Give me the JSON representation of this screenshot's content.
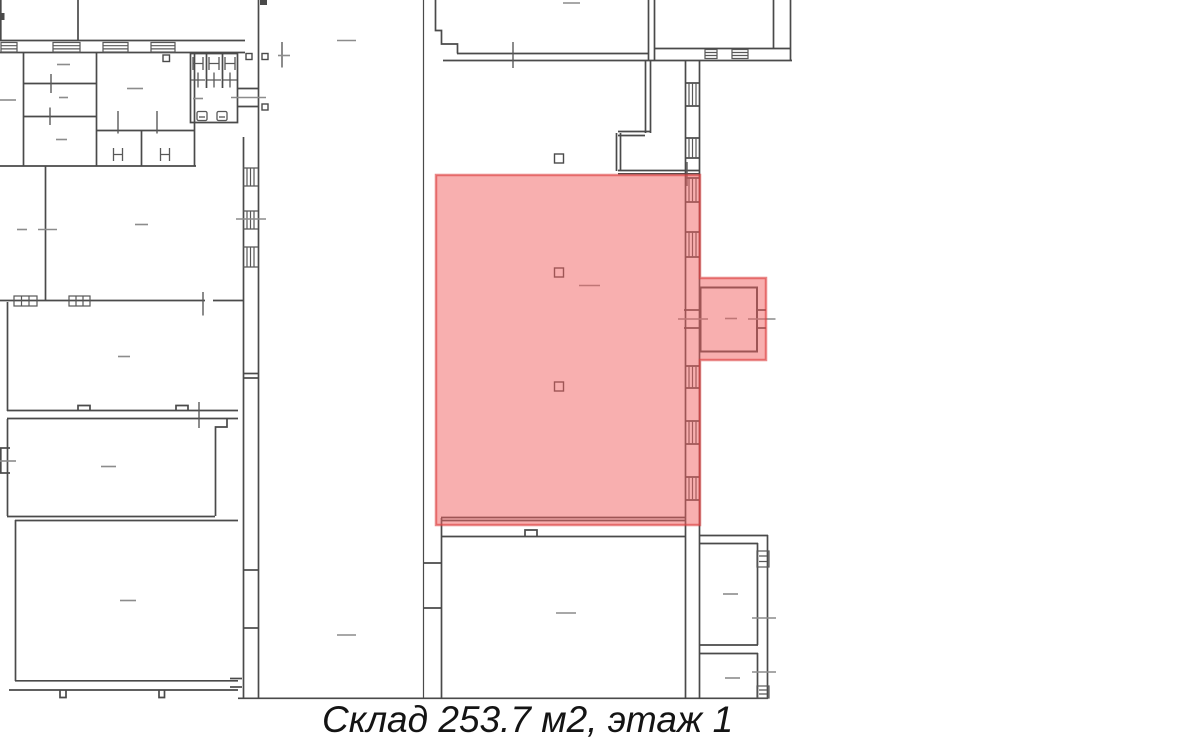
{
  "plan": {
    "type": "floor-plan",
    "wall_color": "#4a4a4a",
    "fixture_color": "#585858",
    "tick_color": "#8c8c8c",
    "background": "#ffffff"
  },
  "highlight": {
    "area_name": "Склад",
    "area_m2": "253.7",
    "floor": "1",
    "fill": "rgba(242,95,95,0.5)",
    "stroke": "rgba(219,63,63,0.62)"
  },
  "caption": {
    "text": "Склад 253.7 м2, этаж 1"
  }
}
